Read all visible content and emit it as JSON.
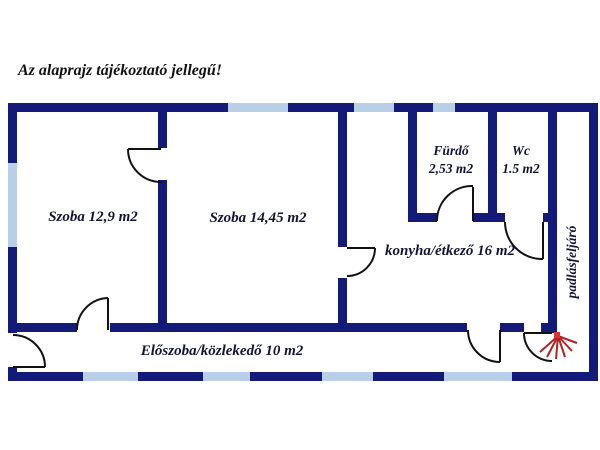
{
  "title": "Az alaprajz tájékoztató jellegű!",
  "rooms": {
    "szoba1": {
      "label": "Szoba 12,9 m2"
    },
    "szoba2": {
      "label": "Szoba 14,45 m2"
    },
    "furdo": {
      "label": "Fürdő",
      "area": "2,53 m2"
    },
    "wc": {
      "label": "Wc",
      "area": "1.5 m2"
    },
    "konyha": {
      "label": "konyha/étkező 16 m2"
    },
    "eloszoba": {
      "label": "Előszoba/közlekedő 10 m2"
    },
    "padlasfeljaro": {
      "label": "padlásfeljáró"
    }
  },
  "icons": {
    "attic_stairs": "radiating-red-lines"
  },
  "colors": {
    "background": "#ffffff",
    "wall": "#141a78",
    "window": "#b9cfe8",
    "door_line": "#121212",
    "label": "#131339",
    "title": "#111111",
    "stairs_red": "#b22222",
    "stairs_hub": "#e03030"
  }
}
